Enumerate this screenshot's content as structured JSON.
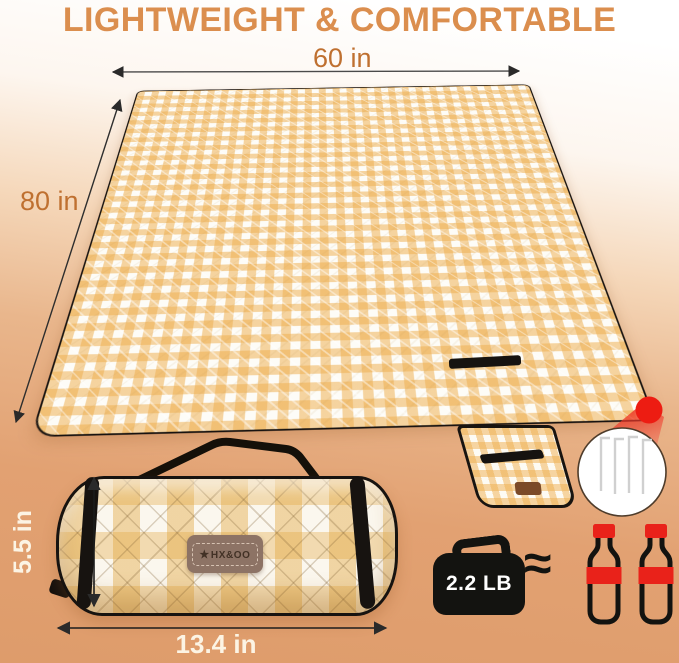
{
  "title": {
    "text": "LIGHTWEIGHT & COMFORTABLE"
  },
  "dimensions": {
    "blanket_width": "60 in",
    "blanket_length": "80 in",
    "roll_height": "5.5 in",
    "roll_width": "13.4 in"
  },
  "weight_badge": {
    "label": "2.2 LB",
    "approx_symbol": "≈"
  },
  "brand_patch": {
    "star": "★",
    "name": "HX&OO"
  },
  "icons": {
    "weight": "weight-bag-icon",
    "bottle": "cola-bottle-icon",
    "stakes": "tent-stakes-icon",
    "corner_callout": "red-dot-callout"
  },
  "colors": {
    "headline_orange": "#DB8E4E",
    "dimension_brown": "#BF7030",
    "dimension_cream": "#FCF4E4",
    "gingham_yellow": "#EEAE4E",
    "background_tan": "#E2A172",
    "trim_black": "#171310",
    "accent_red": "#E9221A",
    "patch_brown": "#8D7365"
  }
}
